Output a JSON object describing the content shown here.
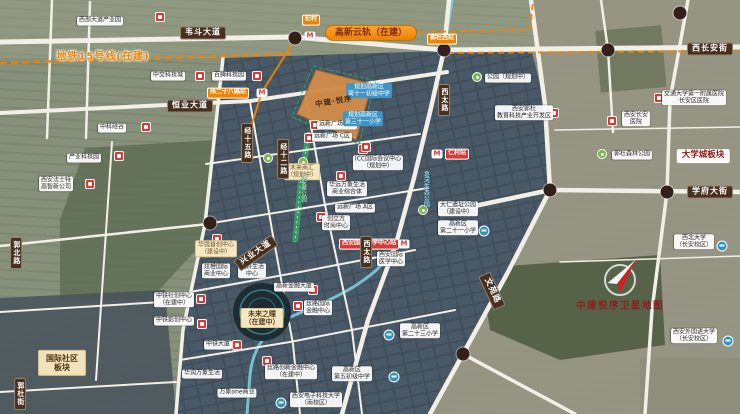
{
  "watermark": "中建悦序卫星地图",
  "project": {
    "parcel_label": "中建·悦序"
  },
  "transit": {
    "metro15_label": "地铁15号线(在建)",
    "yungui_label": "高新云轨（在建）"
  },
  "districts": {
    "university_town": "大学城板块",
    "intl_community_line1": "国际社区",
    "intl_community_line2": "板块",
    "future_eye_line1": "未来之瞳",
    "future_eye_line2": "（在建中）"
  },
  "colors": {
    "accent_orange": "#f08300",
    "road_label_bg": "#47301f",
    "station_red": "#d93a36",
    "school_blue": "#2f93c8",
    "water": "#7cd2e8",
    "park_green": "#38a065",
    "parcel_orange": "#d08c4a",
    "watermark_red": "#8b1e1e"
  },
  "map": {
    "labels": [
      {
        "type": "poi",
        "lines": [
          "西部大道产业园"
        ],
        "x": 100,
        "y": 21
      },
      {
        "type": "poi",
        "lines": [
          "中交科技城"
        ],
        "x": 168,
        "y": 76
      },
      {
        "type": "poi",
        "lines": [
          "百腾科技园"
        ],
        "x": 229,
        "y": 76
      },
      {
        "type": "poi",
        "lines": [
          "中科硅谷"
        ],
        "x": 112,
        "y": 128
      },
      {
        "type": "poi",
        "lines": [
          "产业科技园"
        ],
        "x": 84,
        "y": 158
      },
      {
        "type": "poi",
        "lines": [
          "西安法士特",
          "高智新公司"
        ],
        "x": 56,
        "y": 184
      },
      {
        "type": "poi",
        "lines": [
          "公园（规划中）"
        ],
        "x": 508,
        "y": 78
      },
      {
        "type": "poi",
        "lines": [
          "西安郭杜",
          "教育科技产业开发区"
        ],
        "x": 524,
        "y": 113
      },
      {
        "type": "poi",
        "lines": [
          "西安长安",
          "医院"
        ],
        "x": 636,
        "y": 119
      },
      {
        "type": "poi",
        "lines": [
          "交通大学第一附属医院",
          "长安区医院"
        ],
        "x": 694,
        "y": 98
      },
      {
        "type": "poi",
        "lines": [
          "郭杜森林公园"
        ],
        "x": 632,
        "y": 155
      },
      {
        "type": "poi",
        "lines": [
          "大仁遗址公园",
          "（建设中）"
        ],
        "x": 458,
        "y": 209
      },
      {
        "type": "poi",
        "lines": [
          "高新区",
          "第二十一小学"
        ],
        "x": 458,
        "y": 228
      },
      {
        "type": "poi",
        "lines": [
          "西安国际",
          "医学中心"
        ],
        "x": 391,
        "y": 259
      },
      {
        "type": "poi",
        "lines": [
          "西北大学",
          "（长安校区）"
        ],
        "x": 694,
        "y": 242
      },
      {
        "type": "poi",
        "lines": [
          "西安外国语大学",
          "（长安校区）"
        ],
        "x": 694,
        "y": 336
      },
      {
        "type": "poi",
        "lines": [
          "西安电子科技大学",
          "（南校区）"
        ],
        "x": 316,
        "y": 400
      },
      {
        "type": "poi",
        "lines": [
          "高新区",
          "第五初级中学"
        ],
        "x": 352,
        "y": 374
      },
      {
        "type": "poi",
        "lines": [
          "高新区",
          "第二十三小学"
        ],
        "x": 420,
        "y": 331
      },
      {
        "type": "poi",
        "lines": [
          "中铁社创中心",
          "（在建中）"
        ],
        "x": 174,
        "y": 300
      },
      {
        "type": "poi",
        "lines": [
          "中铁影创中心"
        ],
        "x": 174,
        "y": 321
      },
      {
        "type": "poi",
        "lines": [
          "中铁大厦"
        ],
        "x": 218,
        "y": 345
      },
      {
        "type": "poi",
        "lines": [
          "高新金融大厦"
        ],
        "x": 294,
        "y": 287
      },
      {
        "type": "poi",
        "lines": [
          "丝路国际",
          "金融中心"
        ],
        "x": 318,
        "y": 308
      },
      {
        "type": "poi",
        "lines": [
          "丝路创新金融中心",
          "（在建中）"
        ],
        "x": 291,
        "y": 372
      },
      {
        "type": "poi",
        "lines": [
          "华润万象生活"
        ],
        "x": 202,
        "y": 374
      },
      {
        "type": "poi",
        "lines": [
          "万象one商业"
        ],
        "x": 237,
        "y": 393
      },
      {
        "type": "poi",
        "lines": [
          "炫橙国际",
          "商业中心"
        ],
        "x": 216,
        "y": 271
      },
      {
        "type": "poi",
        "lines": [
          "美好生活",
          "中心"
        ],
        "x": 252,
        "y": 271
      },
      {
        "type": "poi",
        "lines": [
          "创立方",
          "时尚中心"
        ],
        "x": 336,
        "y": 223
      },
      {
        "type": "poi",
        "lines": [
          "ICC国际会议中心",
          "（规划中）"
        ],
        "x": 378,
        "y": 163
      },
      {
        "type": "poi",
        "lines": [
          "华远万象生活",
          "商业综合体"
        ],
        "x": 347,
        "y": 189
      },
      {
        "type": "poi",
        "lines": [
          "远新广场 B区"
        ],
        "x": 337,
        "y": 125
      },
      {
        "type": "poi",
        "lines": [
          "远新广场 C区"
        ],
        "x": 332,
        "y": 137
      },
      {
        "type": "poi",
        "lines": [
          "远新广场 A区"
        ],
        "x": 355,
        "y": 208
      },
      {
        "type": "school",
        "lines": [
          "规划高新区",
          "第十一初级中学"
        ],
        "x": 369,
        "y": 91
      },
      {
        "type": "school",
        "lines": [
          "规划高新区",
          "第三十一小学"
        ],
        "x": 363,
        "y": 119
      },
      {
        "type": "tan",
        "lines": [
          "未来商汇",
          "（规划中）"
        ],
        "x": 302,
        "y": 172
      },
      {
        "type": "tan",
        "lines": [
          "华强首创中心",
          "（建设中）"
        ],
        "x": 216,
        "y": 249
      },
      {
        "type": "station-orange",
        "lines": [
          "纪村"
        ],
        "x": 311,
        "y": 20
      },
      {
        "type": "station-orange",
        "lines": [
          "郭杜西站"
        ],
        "x": 442,
        "y": 39
      },
      {
        "type": "station-orange",
        "lines": [
          "纬二十八路站"
        ],
        "x": 228,
        "y": 93
      },
      {
        "type": "station-red",
        "lines": [
          "仁村站"
        ],
        "x": 457,
        "y": 154
      },
      {
        "type": "station-red",
        "lines": [
          "西安国际医学中心站"
        ],
        "x": 369,
        "y": 244
      },
      {
        "type": "road-h",
        "lines": [
          "韦斗大道"
        ],
        "x": 203,
        "y": 33
      },
      {
        "type": "road-h",
        "lines": [
          "西长安街"
        ],
        "x": 710,
        "y": 49
      },
      {
        "type": "road-h",
        "lines": [
          "恒业大道"
        ],
        "x": 190,
        "y": 106
      },
      {
        "type": "road-h",
        "lines": [
          "学府大街"
        ],
        "x": 710,
        "y": 192
      },
      {
        "type": "road-v",
        "lines": [
          "西太路"
        ],
        "x": 444,
        "y": 100
      },
      {
        "type": "road-v",
        "lines": [
          "西太路"
        ],
        "x": 366,
        "y": 252
      },
      {
        "type": "road-v",
        "lines": [
          "经十五路"
        ],
        "x": 247,
        "y": 143
      },
      {
        "type": "road-v",
        "lines": [
          "经十二路"
        ],
        "x": 283,
        "y": 159
      },
      {
        "type": "road-v",
        "lines": [
          "郭北路"
        ],
        "x": 16,
        "y": 253
      },
      {
        "type": "road-v",
        "lines": [
          "郭杜街"
        ],
        "x": 20,
        "y": 394
      },
      {
        "type": "road-rot",
        "lines": [
          "文苑路"
        ],
        "x": 492,
        "y": 291,
        "rot": 65
      },
      {
        "type": "road-rot",
        "lines": [
          "兴业大道"
        ],
        "x": 256,
        "y": 253,
        "rot": -35
      },
      {
        "type": "water-text",
        "lines": [
          "皂河生态公园"
        ],
        "x": 425,
        "y": 189
      },
      {
        "type": "ribbon-text",
        "lines": [
          "永安渠公园"
        ],
        "x": 303,
        "y": 188
      }
    ],
    "icons": [
      {
        "type": "metro",
        "x": 310,
        "y": 36
      },
      {
        "type": "metro",
        "x": 262,
        "y": 93
      },
      {
        "type": "metro",
        "x": 437,
        "y": 154
      },
      {
        "type": "metro",
        "x": 404,
        "y": 244
      },
      {
        "type": "red",
        "x": 160,
        "y": 17
      },
      {
        "type": "red",
        "x": 200,
        "y": 76
      },
      {
        "type": "red",
        "x": 257,
        "y": 76
      },
      {
        "type": "red",
        "x": 146,
        "y": 127
      },
      {
        "type": "red",
        "x": 119,
        "y": 156
      },
      {
        "type": "red",
        "x": 90,
        "y": 184
      },
      {
        "type": "red",
        "x": 554,
        "y": 113
      },
      {
        "type": "red",
        "x": 659,
        "y": 98
      },
      {
        "type": "red",
        "x": 612,
        "y": 121
      },
      {
        "type": "red",
        "x": 201,
        "y": 299
      },
      {
        "type": "red",
        "x": 202,
        "y": 324
      },
      {
        "type": "red",
        "x": 237,
        "y": 345
      },
      {
        "type": "red",
        "x": 313,
        "y": 290
      },
      {
        "type": "red",
        "x": 298,
        "y": 306
      },
      {
        "type": "red",
        "x": 267,
        "y": 361
      },
      {
        "type": "red",
        "x": 321,
        "y": 217
      },
      {
        "type": "red",
        "x": 363,
        "y": 149
      },
      {
        "type": "red",
        "x": 341,
        "y": 176
      },
      {
        "type": "red",
        "x": 315,
        "y": 125
      },
      {
        "type": "red",
        "x": 309,
        "y": 138
      },
      {
        "type": "red",
        "x": 366,
        "y": 147
      },
      {
        "type": "red",
        "x": 217,
        "y": 239
      },
      {
        "type": "green",
        "x": 477,
        "y": 77
      },
      {
        "type": "green",
        "x": 602,
        "y": 154
      },
      {
        "type": "green",
        "x": 423,
        "y": 210
      },
      {
        "type": "green",
        "x": 268,
        "y": 158
      },
      {
        "type": "green",
        "x": 303,
        "y": 162
      },
      {
        "type": "school",
        "x": 484,
        "y": 231
      },
      {
        "type": "school",
        "x": 722,
        "y": 246
      },
      {
        "type": "school",
        "x": 728,
        "y": 341
      },
      {
        "type": "school",
        "x": 281,
        "y": 403
      },
      {
        "type": "school",
        "x": 394,
        "y": 377
      },
      {
        "type": "school",
        "x": 389,
        "y": 335
      },
      {
        "type": "dot",
        "x": 295,
        "y": 38
      },
      {
        "type": "dot",
        "x": 444,
        "y": 50
      },
      {
        "type": "dot",
        "x": 608,
        "y": 50
      },
      {
        "type": "dot",
        "x": 680,
        "y": 13
      },
      {
        "type": "dot",
        "x": 550,
        "y": 190
      },
      {
        "type": "dot",
        "x": 667,
        "y": 192
      },
      {
        "type": "dot",
        "x": 210,
        "y": 223
      },
      {
        "type": "dot",
        "x": 463,
        "y": 354
      }
    ]
  }
}
